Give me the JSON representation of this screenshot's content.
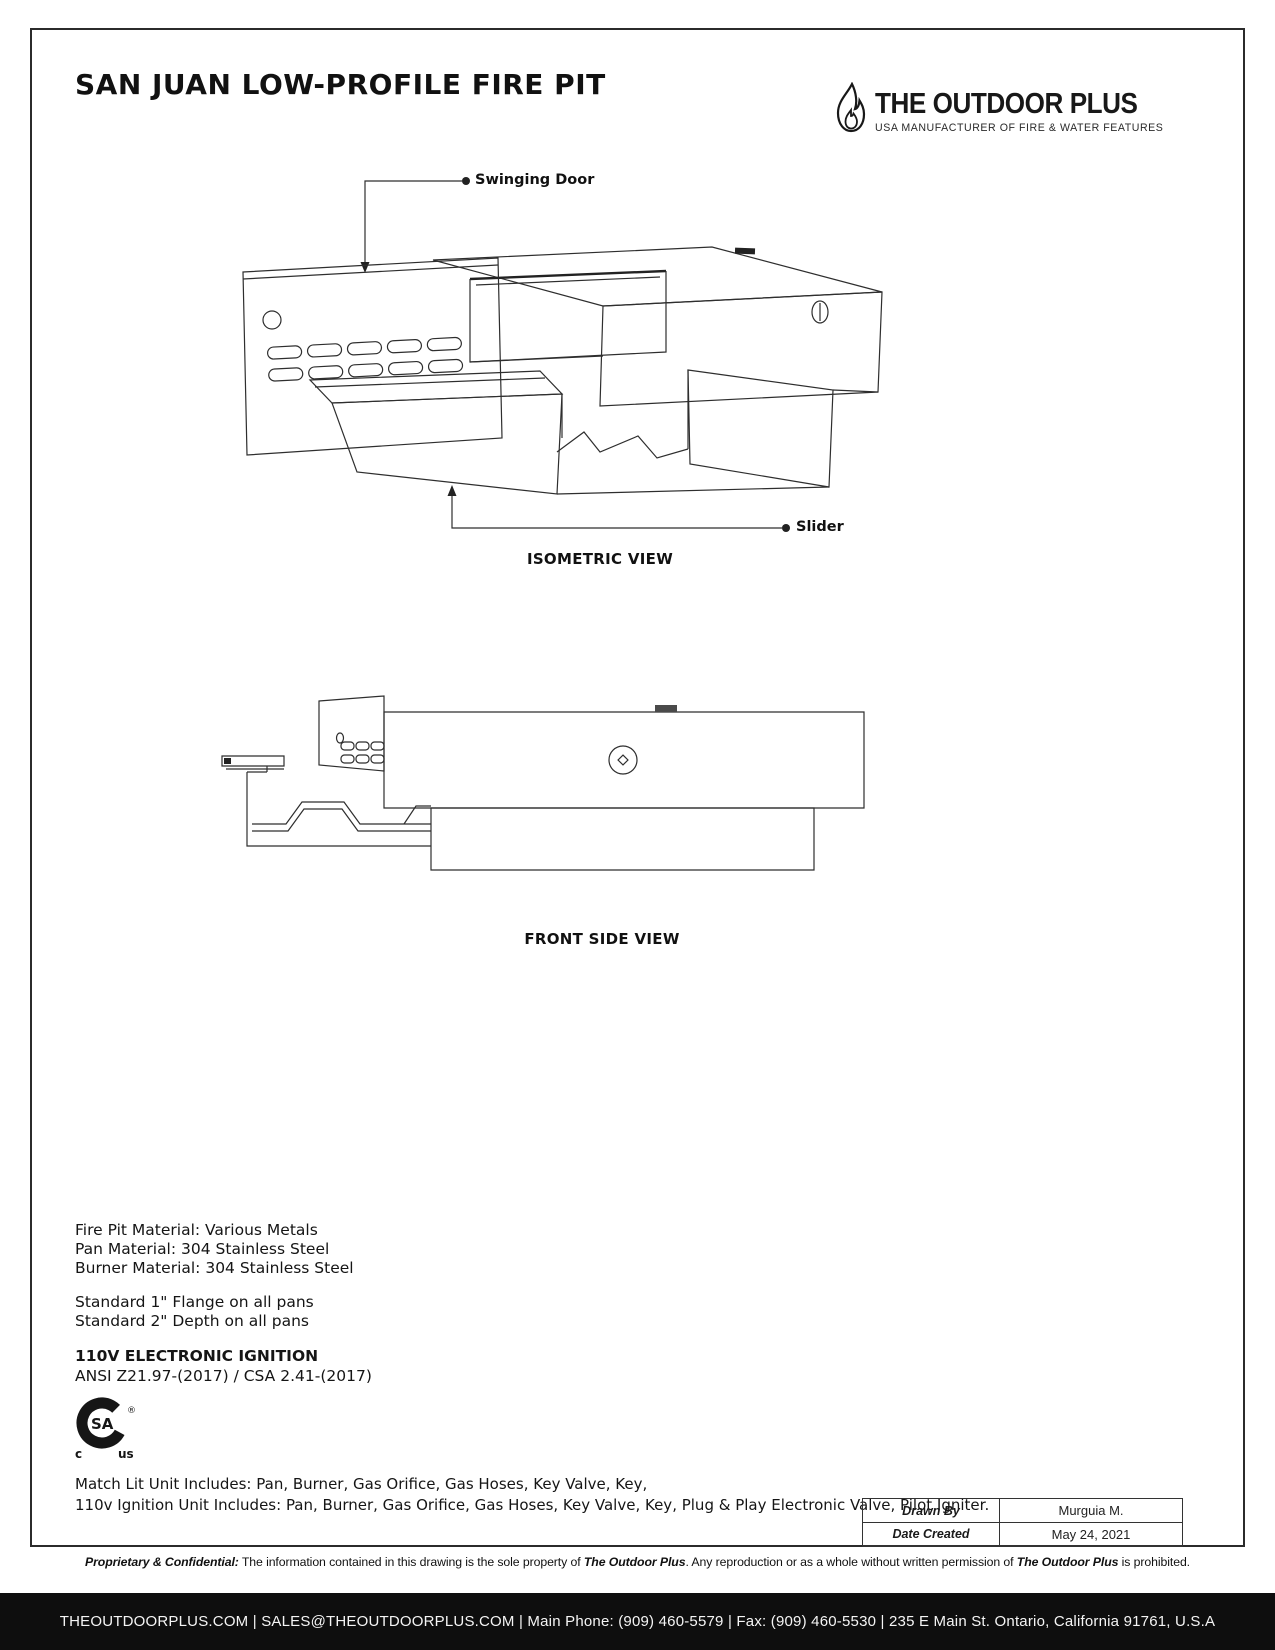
{
  "header": {
    "title": "SAN JUAN LOW-PROFILE FIRE PIT"
  },
  "logo": {
    "name": "THE OUTDOOR PLUS",
    "tagline": "USA MANUFACTURER OF FIRE & WATER FEATURES"
  },
  "iso": {
    "caption": "ISOMETRIC VIEW",
    "label_door": "Swinging Door",
    "label_slider": "Slider"
  },
  "front": {
    "caption": "FRONT SIDE VIEW"
  },
  "specs": {
    "materials": [
      "Fire Pit Material: Various Metals",
      "Pan Material: 304 Stainless Steel",
      "Burner Material: 304 Stainless Steel"
    ],
    "standards": [
      "Standard 1\" Flange on all pans",
      "Standard 2\" Depth on all pans"
    ],
    "ignition_title": "110V ELECTRONIC IGNITION",
    "certification": "ANSI Z21.97-(2017) / CSA 2.41-(2017)",
    "includes": [
      "Match Lit Unit Includes: Pan, Burner, Gas Orifice, Gas Hoses, Key Valve, Key,",
      "110v Ignition Unit Includes: Pan, Burner, Gas Orifice, Gas Hoses, Key Valve, Key, Plug & Play Electronic Valve, Pilot Igniter."
    ]
  },
  "csa": {
    "sa": "SA",
    "reg": "®",
    "c": "c",
    "us": "us"
  },
  "title_block": {
    "rows": [
      {
        "label": "Drawn By",
        "value": "Murguia M."
      },
      {
        "label": "Date Created",
        "value": "May 24, 2021"
      }
    ]
  },
  "footer": {
    "p1": "Proprietary & Confidential:",
    "p2": " The information contained in this drawing is the sole property of ",
    "b1": "The Outdoor Plus",
    "p3": ". Any reproduction or as a whole without written permission of ",
    "b2": "The Outdoor Plus",
    "p4": " is prohibited.",
    "contact": "THEOUTDOORPLUS.COM   |   SALES@THEOUTDOORPLUS.COM   |  Main Phone: (909) 460-5579  |  Fax: (909) 460-5530  |  235 E Main St. Ontario, California 91761, U.S.A"
  },
  "colors": {
    "ink": "#1a1a1a",
    "bar_bg": "#0e0e0e"
  }
}
